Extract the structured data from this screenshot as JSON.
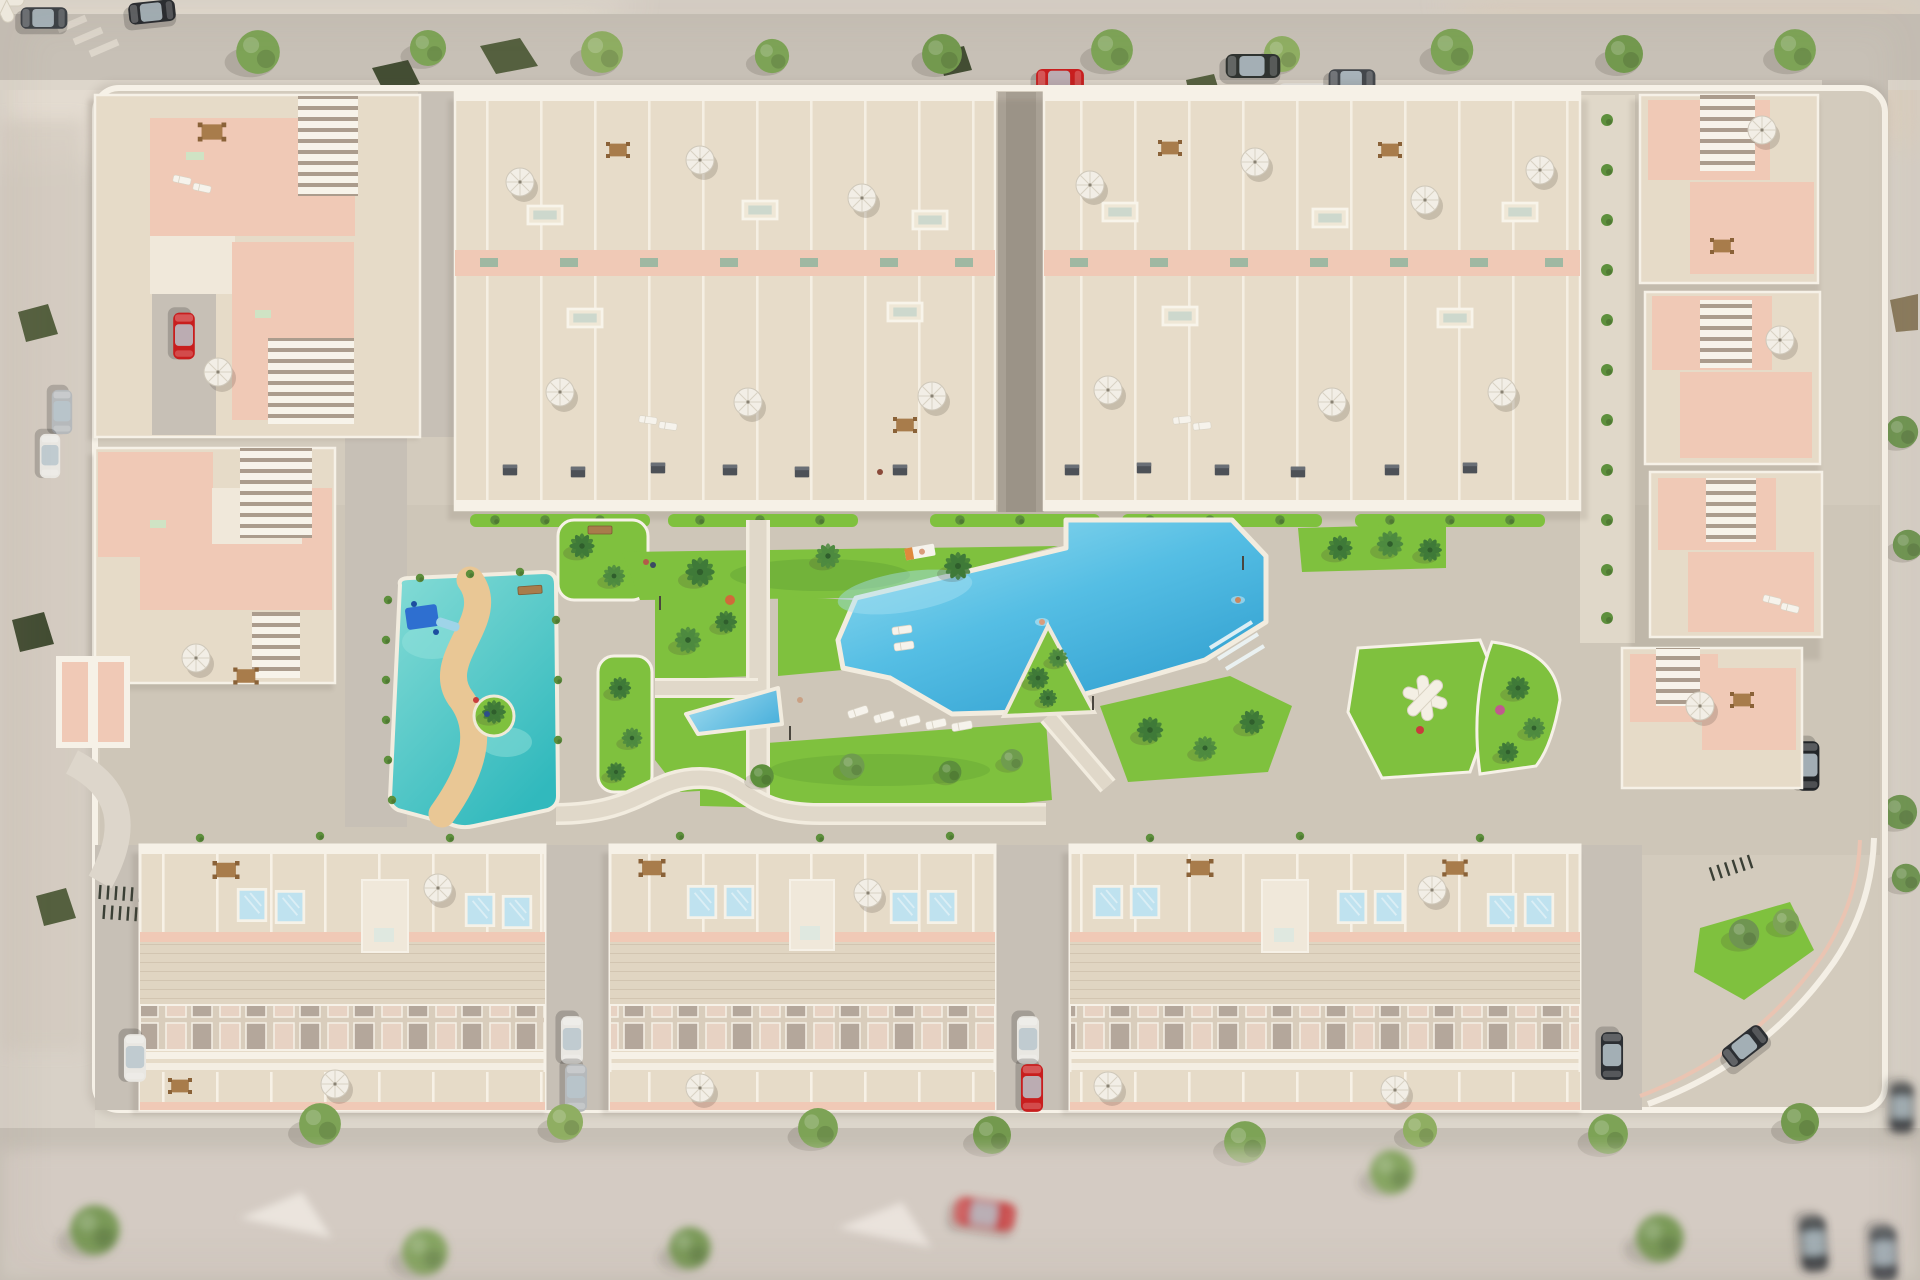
{
  "scene": {
    "title": "Aerial 3D architectural render of a gated residential complex with central lagoon pool, gardens, splash playground and townhouse rows",
    "view": "bird's-eye view, daytime, long soft shadows falling to the lower-left",
    "style": "Mediterranean new-build development render; blurred streets and low-poly trees around the perimeter"
  },
  "palette": {
    "ground": "#d8d1c7",
    "ground_warm": "#e2d6cc",
    "road": "#c7c0b6",
    "sidewalk": "#ddd6cb",
    "complex_paving": "#d3cbbd",
    "plaza_paving": "#cec6b8",
    "path": "#e0d8c9",
    "wall_white": "#f6f1e7",
    "building_pink": "#f0c9b6",
    "building_pink_deep": "#e3b19d",
    "roof_beige": "#e7dcc9",
    "roof_light": "#f0e8da",
    "terrace_floor": "#e6dbc8",
    "louver_shadow": "#ab9c8d",
    "grass": "#7fc13e",
    "grass_deep": "#549231",
    "hedge": "#5d8f3c",
    "palm": "#3f7a38",
    "tree": "#7da356",
    "tree_olive": "#55603f",
    "pool_light": "#9bdff0",
    "pool_blue": "#55bee4",
    "pool_deep": "#2f9ecf",
    "kids_teal": "#3cc4c4",
    "kids_teal_light": "#86dcd6",
    "sand": "#e9c795",
    "umbrella": "#f2eee6",
    "wood": "#a87c4b",
    "play_blue": "#2e6fd0",
    "bbq_gray": "#4d5157",
    "car_red": "#c81e1e",
    "car_white": "#e9e7e2",
    "car_silver": "#b6b9bb",
    "car_black": "#26292d",
    "car_olive": "#5c6147",
    "shadow": "#5a5042"
  },
  "areas": {
    "north_townhouses": "Two long clusters of terraced townhouses with roof terraces, parasols and skylights",
    "west_apartments": "Pink apartment blocks with white louvered pergolas and stair towers",
    "east_apartments": "Staggered pink apartment blocks along the east edge with parked cars",
    "central_garden": "Central landscaped garden with lawns, palm trees and white-edged walkways",
    "main_pool": "Lagoon-style communal swimming pool with corner steps and a planted peninsula",
    "kids_playground": "Turquoise splash playground with winding sand path, slide structure and island",
    "small_pool": "Small wedge-shaped plunge pool beside the lawns",
    "relax_garden": "East lawn with white X-shaped lounge seats and a curved hedge bed",
    "south_townhouses": "Three long townhouse rows with rooftop plunge pools, pergola slats and front patios",
    "perimeter_streets": "Surrounding streets with street trees and parked cars, blurred at the edges"
  },
  "objects": {
    "parasols": "white patio umbrellas on roof terraces and patios",
    "sun_loungers": "white sun loungers beside the pool and on terraces",
    "rooftop_pools": "small sky-blue private pools on the south townhouse terraces",
    "dining_sets": "wooden outdoor dining tables with chairs",
    "bbqs": "grey barbecue units along the townhouse fronts",
    "bike_racks": "dark bicycle racks near the entrances",
    "benches": "wooden garden benches",
    "lamp_posts": "slim park lamp posts",
    "people": "small figures walking, sunbathing and swimming"
  },
  "vehicles": {
    "north_street": [
      "red car",
      "dark van",
      "white van",
      "dark sedan",
      "two dark cars at the corner"
    ],
    "east_street": [
      "black SUV",
      "black sedan",
      "silver SUV",
      "black car"
    ],
    "west_street": [
      "silver car",
      "white car",
      "red car in courtyard"
    ],
    "courtyard_driveways": [
      "white car",
      "silver car",
      "white car",
      "red car",
      "white car",
      "dark car"
    ],
    "south_street": [
      "blurred red car",
      "dark cars near the bottom-right corner"
    ]
  }
}
